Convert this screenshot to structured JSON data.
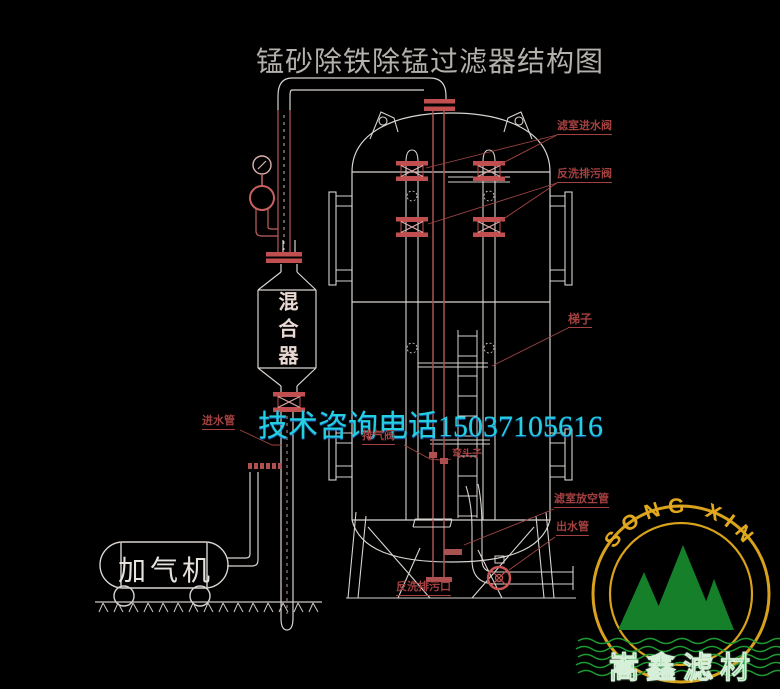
{
  "title": "锰砂除铁除锰过滤器结构图",
  "watermark": {
    "phone_text": "技术咨询电话15037105616"
  },
  "equipment": {
    "mixer_label": "混合器",
    "aerator_label": "加气机"
  },
  "labels": {
    "filter_inlet_valve": "滤室进水阀",
    "backwash_drain_valve": "反洗排污阀",
    "ladder": "梯子",
    "exhaust_valve": "排气阀",
    "elbow": "弯头子",
    "filter_vent_pipe": "滤室放空管",
    "outlet_pipe": "出水管",
    "inlet_pipe": "进水管",
    "backwash_drain_outlet": "反洗排污口"
  },
  "logo": {
    "arc_text": "SONG XIN",
    "company": "嵩鑫滤材",
    "colors": {
      "ring": "#d9a21c",
      "mountain": "#157f29",
      "waves": "#1d9a31",
      "company_text": "#28a53d"
    }
  },
  "colors": {
    "background": "#000000",
    "line_white": "#d8d4d0",
    "pipe_red": "#a85252",
    "flange_red": "#c14f4f",
    "label_red": "#a34040",
    "title_gray": "#b4b0ac",
    "phone_cyan": "#24cfe0"
  }
}
